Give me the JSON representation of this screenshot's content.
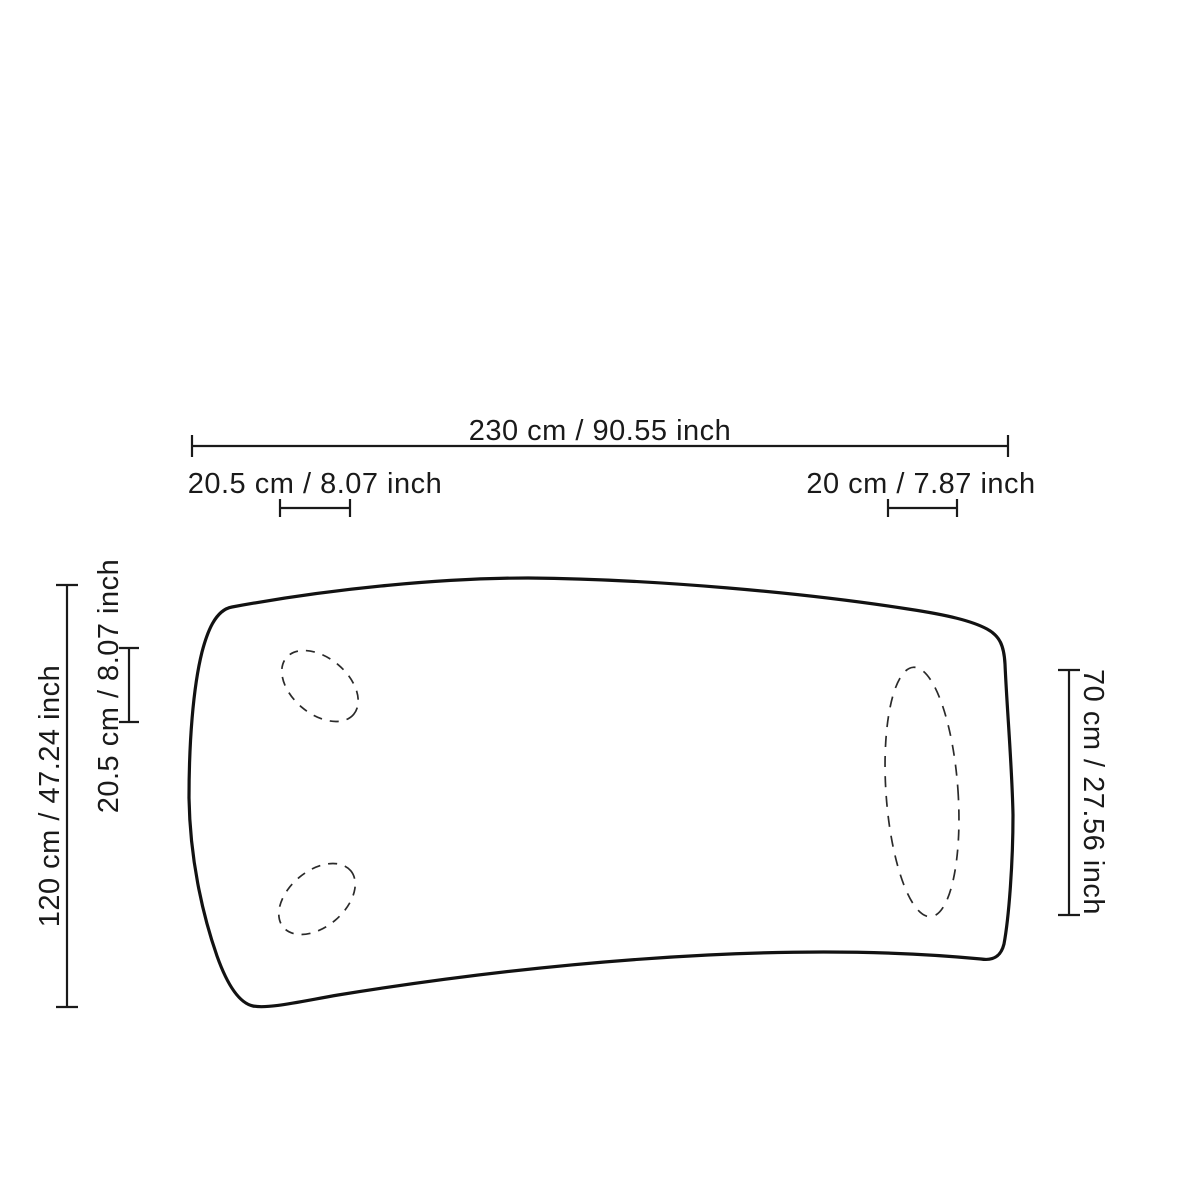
{
  "diagram": {
    "type": "furniture-dimension-drawing",
    "subject": "curved-rectangular-tabletop-top-view",
    "colors": {
      "background": "#ffffff",
      "line": "#1a1a1a"
    },
    "dimensions": {
      "total_width": {
        "label": "230 cm / 90.55 inch",
        "cm": 230,
        "inch": 90.55
      },
      "top_left_inset": {
        "label": "20.5 cm / 8.07 inch",
        "cm": 20.5,
        "inch": 8.07
      },
      "top_right_inset": {
        "label": "20 cm / 7.87 inch",
        "cm": 20,
        "inch": 7.87
      },
      "total_depth": {
        "label": "120 cm / 47.24 inch",
        "cm": 120,
        "inch": 47.24
      },
      "left_side_inset": {
        "label": "20.5 cm / 8.07 inch",
        "cm": 20.5,
        "inch": 8.07
      },
      "right_zone_depth": {
        "label": "70 cm / 27.56 inch",
        "cm": 70,
        "inch": 27.56
      }
    }
  }
}
